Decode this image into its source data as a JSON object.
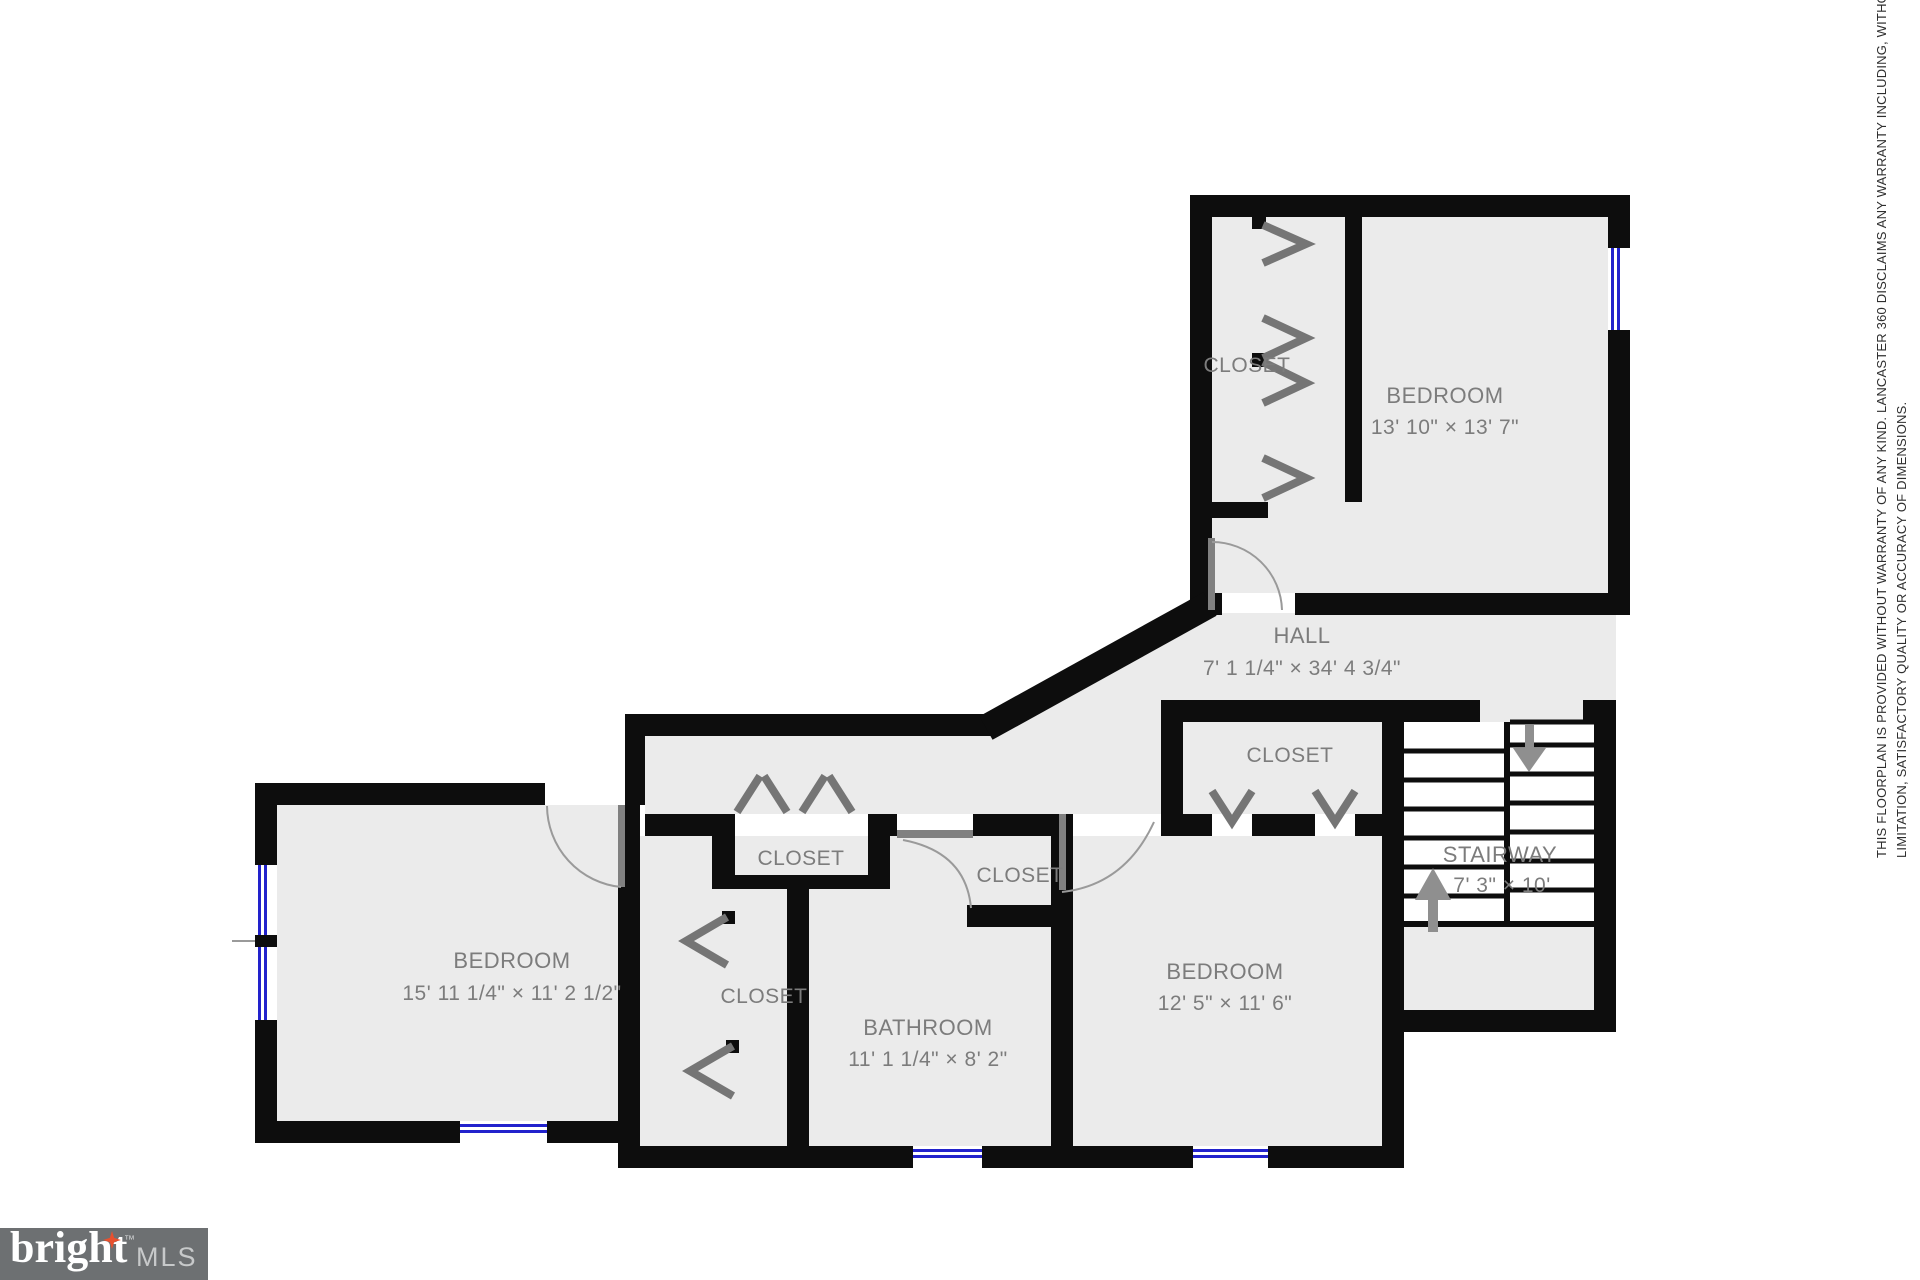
{
  "rooms": {
    "bedroom1": {
      "name": "BEDROOM",
      "dims": "13' 10\" × 13' 7\""
    },
    "hall": {
      "name": "HALL",
      "dims": "7' 1 1/4\" × 34' 4 3/4\""
    },
    "bedroom2": {
      "name": "BEDROOM",
      "dims": "15' 11 1/4\" × 11' 2 1/2\""
    },
    "bathroom": {
      "name": "BATHROOM",
      "dims": "11' 1 1/4\" × 8' 2\""
    },
    "bedroom3": {
      "name": "BEDROOM",
      "dims": "12' 5\" × 11' 6\""
    },
    "stairway": {
      "name": "STAIRWAY",
      "dims": "7' 3\" × 10'"
    }
  },
  "closets": {
    "c1": "CLOSET",
    "c2": "CLOSET",
    "c3": "CLOSET",
    "c4": "CLOSET",
    "c5": "CLOSET"
  },
  "disclaimer": {
    "line1": "THIS FLOORPLAN IS PROVIDED WITHOUT WARRANTY OF ANY KIND. LANCASTER 360 DISCLAIMS ANY WARRANTY INCLUDING, WITHOUT",
    "line2": "LIMITATION, SATISFACTORY QUALITY OR ACCURACY OF DIMENSIONS."
  },
  "logo": {
    "brand": "bright",
    "tm": "™",
    "suffix": "MLS"
  },
  "colors": {
    "wall": "#0d0d0d",
    "floor": "#ebebeb",
    "label": "#7c7c7c",
    "window": "#2222cc",
    "logo_bg": "#6d7072",
    "logo_star": "#e8502e"
  }
}
